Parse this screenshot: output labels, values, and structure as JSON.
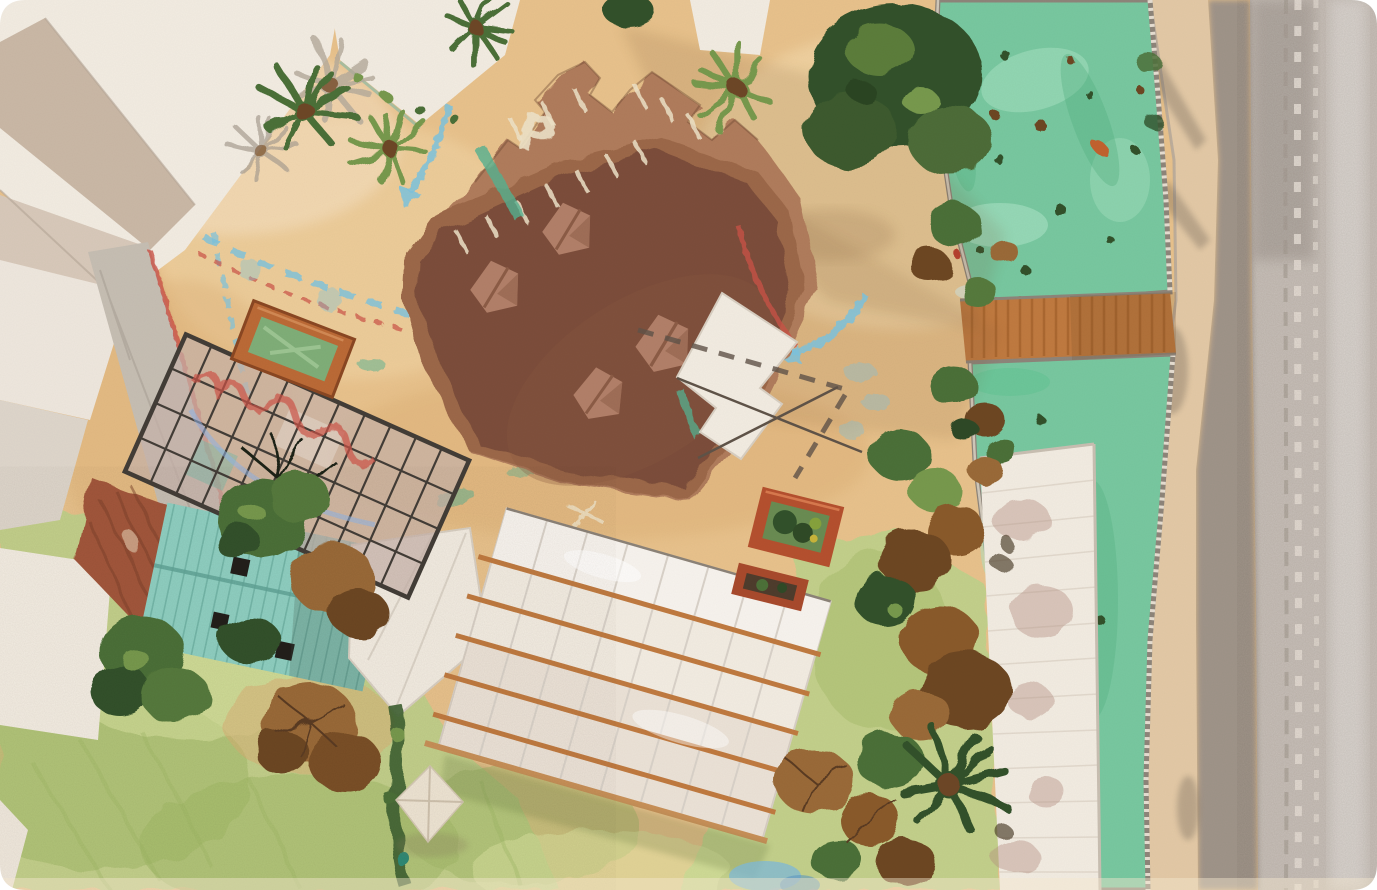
{
  "scene": {
    "type": "aerial photograph, top-down",
    "subject": "architectural scale model: courtyard with parking deck, glass-grid structure, sheds, greenhouse, green canal, footbridge and gravel road",
    "markings": {
      "parking_letter": "P"
    }
  },
  "palette": {
    "sand": "#e8c28c",
    "sand_light": "#f4dcae",
    "sand_deep": "#dcae74",
    "pink_light": "#f6e3c8",
    "platform": "#9c6848",
    "platform_light": "#b07c5c",
    "platform_dark": "#7b4e3a",
    "block": "#b28069",
    "block_dark": "#8c5c46",
    "white_structure": "#f2ece2",
    "white_dim": "#e4dccf",
    "beige": "#cab8a6",
    "grey_wall": "#c6beb3",
    "rust": "#a2573a",
    "rust_dark": "#7c3f28",
    "teal_roof": "#8fd0c2",
    "teal_dark": "#5fa396",
    "glass": "#c8b3ab",
    "grid_line": "#433d37",
    "canal": "#78c8a0",
    "canal_light": "#a9e3c4",
    "canal_deep": "#4fae7f",
    "bridge": "#c07a40",
    "bridge_dark": "#96551f",
    "path_tan": "#e3c9a6",
    "curb": "#b3a89b",
    "road_dark": "#9c9289",
    "road": "#c8c0b9",
    "track": "#e5ded6",
    "grass": "#c3d08b",
    "grass_dark": "#9fb765",
    "grass_light": "#d9e3a0",
    "foliage": "#4c7038",
    "foliage_dark": "#31512a",
    "foliage_light": "#77994e",
    "dead": "#9a6a38",
    "dead_dark": "#6d4722",
    "chalk_blue": "#7cc3de",
    "chalk_red": "#cc5247",
    "chalk_white": "#eee3c8",
    "chalk_teal": "#56b291",
    "planter_orange": "#bb6a36",
    "planter_red": "#b5502e",
    "planter_green": "#6a8c52",
    "tarp": "#eee5d4",
    "shadow": "#7a5531",
    "water_patch": "#7fb9d9",
    "corner_white": "#ffffff"
  }
}
